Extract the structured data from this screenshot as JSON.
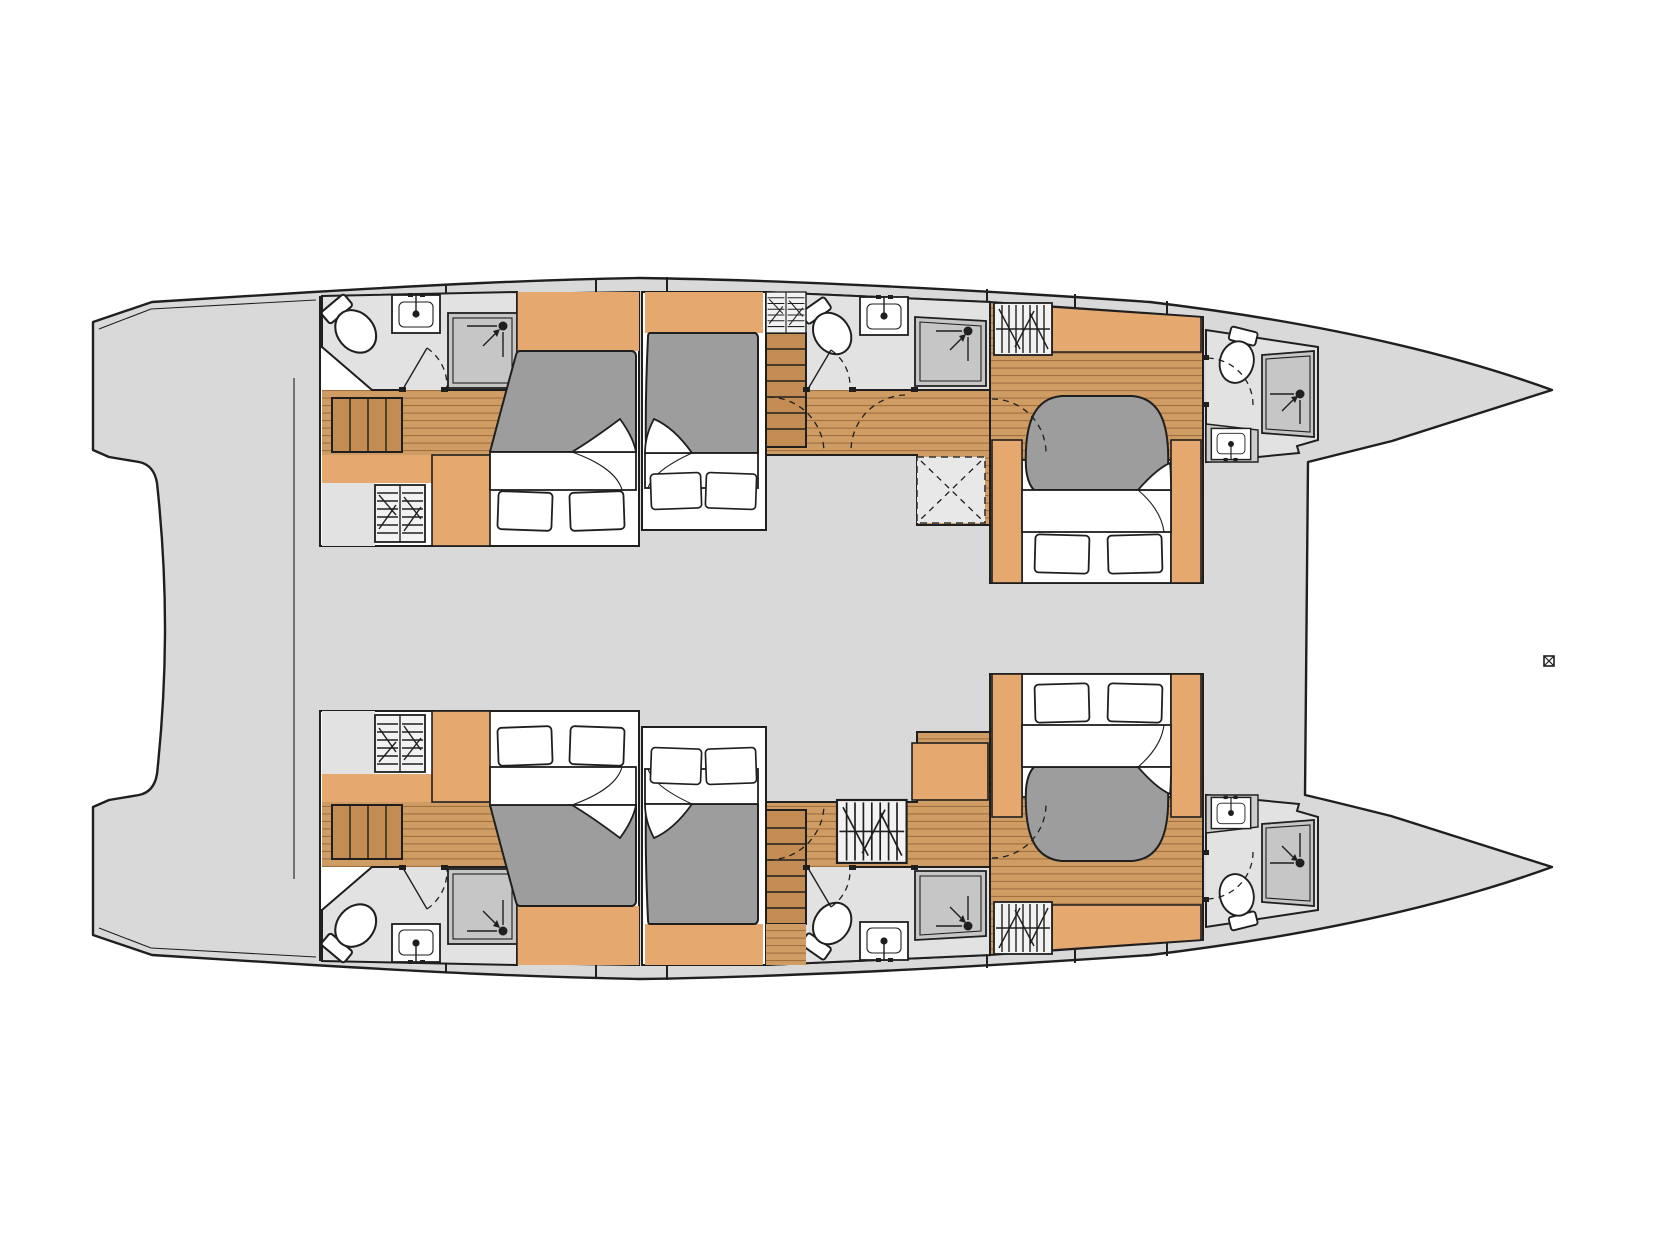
{
  "diagram": {
    "type": "boat-floorplan",
    "description": "Top-down deck plan of a sailing catamaran: two parallel hulls with pointed bows to the right, six double cabins with beds, six en-suite bathrooms (toilet, sink, shower), companionway stairs, wardrobes, one deck hatch and door-swing arcs. No text labels are present in the drawing.",
    "orientation": "bows-right",
    "marker_glyph": "boxed-x"
  },
  "inventory": {
    "hulls": 2,
    "cabins": 6,
    "beds": 6,
    "pillows": 12,
    "bathrooms": 6,
    "toilets": 6,
    "sinks": 6,
    "showers": 6,
    "wardrobes": 6,
    "stair_flights": 4,
    "deck_hatches": 1,
    "door_swings": 10
  },
  "fixture_names": [
    "bed",
    "mattress",
    "duvet",
    "pillow",
    "toilet",
    "sink",
    "shower",
    "wardrobe",
    "stairs",
    "deck-hatch",
    "door-swing-arc",
    "hull-tick"
  ],
  "colors": {
    "paper": "#ffffff",
    "deck": "#d9d9d9",
    "line": "#1f1f1f",
    "line2": "#333333",
    "bath": "#e2e2e2",
    "shower": "#c6c6c6",
    "shelf": "#cccccc",
    "wood": "#cf9c64",
    "woodline": "#6e4319",
    "stair": "#c28c52",
    "orange": "#e5a86f",
    "mattress": "#9d9d9d",
    "white": "#ffffff",
    "hatch": "#e8e8e8",
    "wardrobe": "#f2f2f2"
  }
}
